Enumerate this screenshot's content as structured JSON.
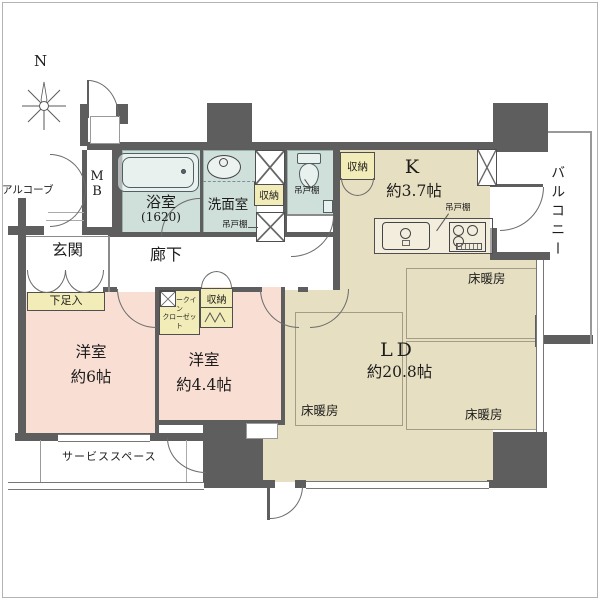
{
  "compass": {
    "north": "N"
  },
  "rooms": {
    "alcove": {
      "name": "アルコーブ"
    },
    "meter_box": {
      "line1": "M",
      "line2": "B"
    },
    "bath": {
      "name": "浴室",
      "size": "(1620)"
    },
    "washroom": {
      "name": "洗面室"
    },
    "kitchen": {
      "name": "K",
      "size": "約3.7帖"
    },
    "living": {
      "name": "LD",
      "size": "約20.8帖"
    },
    "bedroom1": {
      "name": "洋室",
      "size": "約6帖"
    },
    "bedroom2": {
      "name": "洋室",
      "size": "約4.4帖"
    },
    "entrance": {
      "name": "玄関"
    },
    "corridor": {
      "name": "廊下"
    },
    "balcony": {
      "name": "バルコニー"
    },
    "service_space": {
      "name": "サービススペース"
    }
  },
  "features": {
    "storage": "収納",
    "shoe_cabinet": "下足入",
    "hanging_cupboard": "吊戸棚",
    "walk_in_closet_line1": "ウォークイン",
    "walk_in_closet_line2": "クローゼット",
    "floor_heating": "床暖房"
  },
  "colors": {
    "wall": "#5e5e5e",
    "wet": "#cfdfd9",
    "beige": "#e7dfc1",
    "pink": "#f9ded4",
    "yellow": "#f2ecb8",
    "line": "#555555"
  }
}
